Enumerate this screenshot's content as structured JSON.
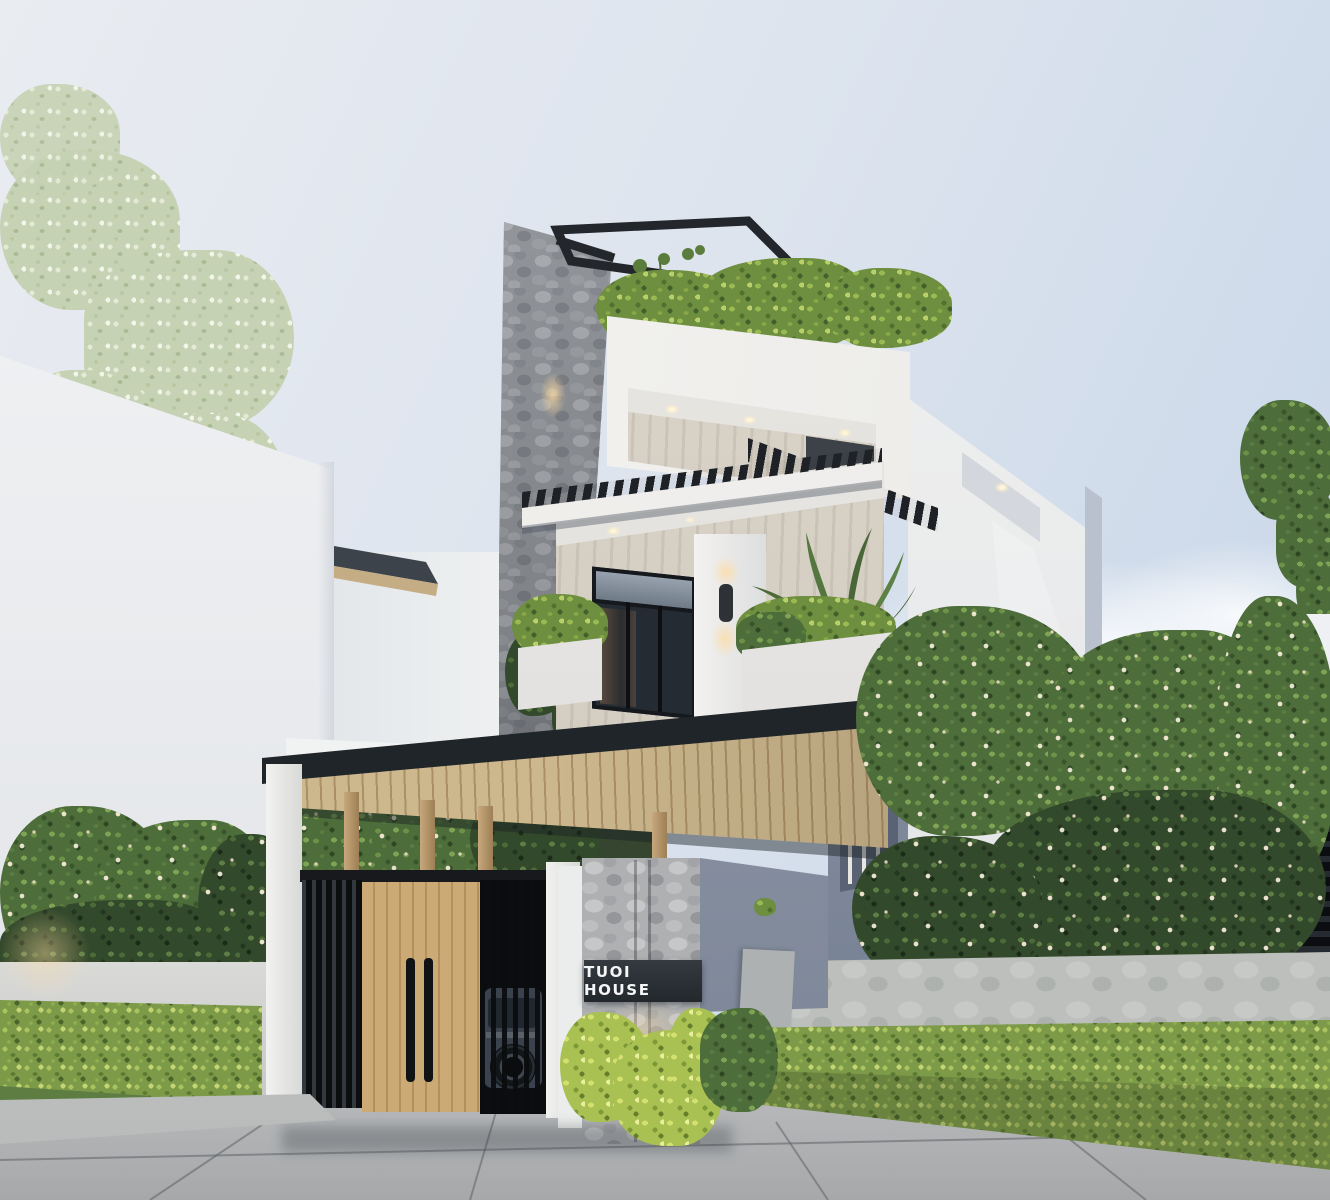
{
  "sign": {
    "label": "TUOI HOUSE",
    "background": "#2c3136",
    "text_color": "#f5f6f7"
  },
  "scene": {
    "description": "Dusk exterior render of a modern three-storey townhouse with a stone feature tower, black steel pergolas, rooftop hedge, timber entry gate and street hedges",
    "time_of_day": "dusk",
    "elements": [
      "sky",
      "clouds",
      "left-neighbor-building",
      "street-tree-left",
      "stone-feature-tower",
      "roof-pergola-frame",
      "rooftop-hedge",
      "third-floor-balcony",
      "second-floor-balcony",
      "glass-doors",
      "wall-sconce",
      "palm-plants",
      "planter-boxes",
      "louver-sunshade",
      "right-wing",
      "carport-canopy",
      "timber-entry-gate",
      "gate-handles",
      "car-behind-gate",
      "house-sign-pillar",
      "flowering-shrubs",
      "street-hedges",
      "louver-screen-right",
      "concrete-fence-walls",
      "sidewalk"
    ]
  },
  "palette": {
    "sky_top": "#e9ecf1",
    "sky_right": "#c5d5e8",
    "wall_white": "#f2f2f0",
    "wall_shadow": "#9aa3b5",
    "stone_grey": "#8f9297",
    "metal_black": "#1d2126",
    "timber": "#c9a873",
    "soffit_tan": "#c9b48b",
    "foliage_green": "#4d6d3a",
    "foliage_bright": "#7fa04b",
    "hedge_green": "#7d9a48",
    "concrete": "#bcbfbb",
    "pavement": "#b0b2b4",
    "glass_dark": "#252b33",
    "warm_light": "#ffdca8",
    "sign_bg": "#2c3136"
  }
}
